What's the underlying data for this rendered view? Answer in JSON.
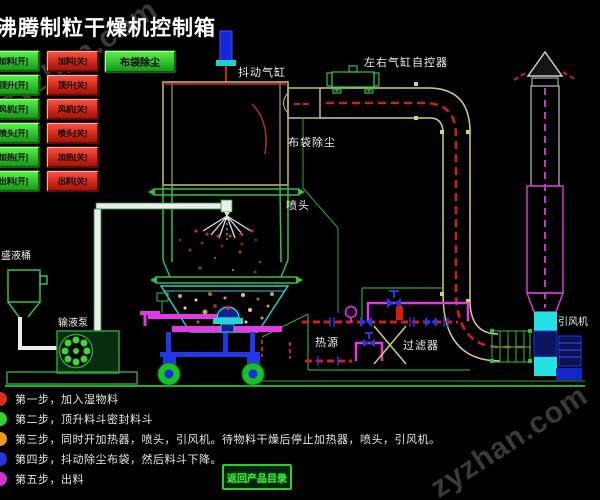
{
  "title": "沸腾制粒干燥机控制箱",
  "watermark": "zyzhan.com",
  "control_panel": {
    "bag_dust_button": "布袋除尘",
    "on_buttons": [
      "加料[开]",
      "顶升[开]",
      "风机[开]",
      "喷头[开]",
      "加热[开]",
      "出料[开]"
    ],
    "off_buttons": [
      "加料[关]",
      "顶升[关]",
      "风机[关]",
      "喷头[关]",
      "加热[关]",
      "出料[关]"
    ]
  },
  "diagram_labels": {
    "shake_cylinder": "抖动气缸",
    "lr_cylinder_controller": "左右气缸自控器",
    "bag_dust": "布袋除尘",
    "spray_head": "喷头",
    "liquid_tank": "盛液桶",
    "liquid_pump": "输液泵",
    "heat_source": "热源",
    "filter": "过滤器",
    "draft_fan": "引风机"
  },
  "steps": [
    {
      "bullet_color": "#d83020",
      "text": "第一步，加入湿物料"
    },
    {
      "bullet_color": "#35d035",
      "text": "第二步，顶升料斗密封料斗"
    },
    {
      "bullet_color": "#e89a25",
      "text": "第三步，同时开加热器，喷头，引风机。待物料干燥后停止加热器，喷头，引风机。"
    },
    {
      "bullet_color": "#2a35d8",
      "text": "第四步，抖动除尘布袋，然后料斗下降。"
    },
    {
      "bullet_color": "#cc35cc",
      "text": "第五步，出料"
    }
  ],
  "footer": {
    "return_button": "返回产品目录"
  },
  "colors": {
    "background": "#000000",
    "panel_green": "#2ec22e",
    "panel_red": "#d42a1a",
    "duct_outline_khaki": "#c9bd72",
    "duct_centerline_red": "#cc2222",
    "stack_magenta": "#d43ad4",
    "pipe_magenta": "#e23ae2",
    "hopper_cyan": "#25cccc",
    "fan_cyan": "#25e2e2",
    "valve_blue": "#2336e8",
    "frame_green": "#2aa03a",
    "watermark_gray": "#3a3a3a"
  }
}
